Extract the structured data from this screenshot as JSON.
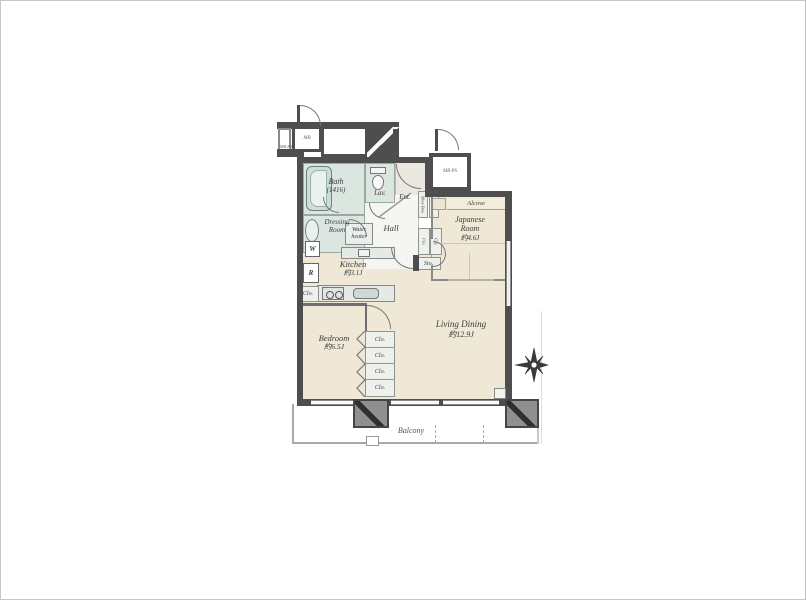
{
  "plan": {
    "title": "apartment-floor-plan",
    "rooms": {
      "bath": {
        "name": "Bath",
        "size": "(1416)"
      },
      "lavatory": {
        "name": "Lav."
      },
      "dressing_room": {
        "line1": "Dressing",
        "line2": "Room"
      },
      "water_heater": {
        "line1": "Water",
        "line2": "heater"
      },
      "washer": {
        "abbr": "W"
      },
      "refrigerator": {
        "abbr": "R"
      },
      "kitchen": {
        "name": "Kitchen",
        "size": "約3.1J"
      },
      "hall": {
        "name": "Hall"
      },
      "entrance": {
        "name": "Ent."
      },
      "storage": {
        "abbr": "Sto."
      },
      "meter_box": {
        "abbr": "MB"
      },
      "meter_box_pipe_space": {
        "abbr": "MB·PS"
      },
      "japanese_room": {
        "line1": "Japanese",
        "line2": "Room",
        "size": "約4.6J"
      },
      "alcove": {
        "name": "Alcove"
      },
      "living_dining": {
        "name": "Living Dining",
        "size": "約12.9J"
      },
      "bedroom": {
        "name": "Bedroom",
        "size": "約6.5J"
      },
      "balcony": {
        "name": "Balcony"
      }
    },
    "closets": {
      "kitchen_side": "Clo.",
      "entry_strip_1": "Shoe Box",
      "entry_strip_2": "Clo.",
      "hall_cells": [
        "Clo.",
        "Clo."
      ],
      "column": [
        "Clo.",
        "Clo.",
        "Clo.",
        "Clo."
      ]
    },
    "colors": {
      "wall": "#4e4e4e",
      "floor": "#efe8d6",
      "wet_area": "#dbe6e1",
      "hall_floor": "#f5f5f1",
      "line": "#8a8a8a"
    }
  }
}
